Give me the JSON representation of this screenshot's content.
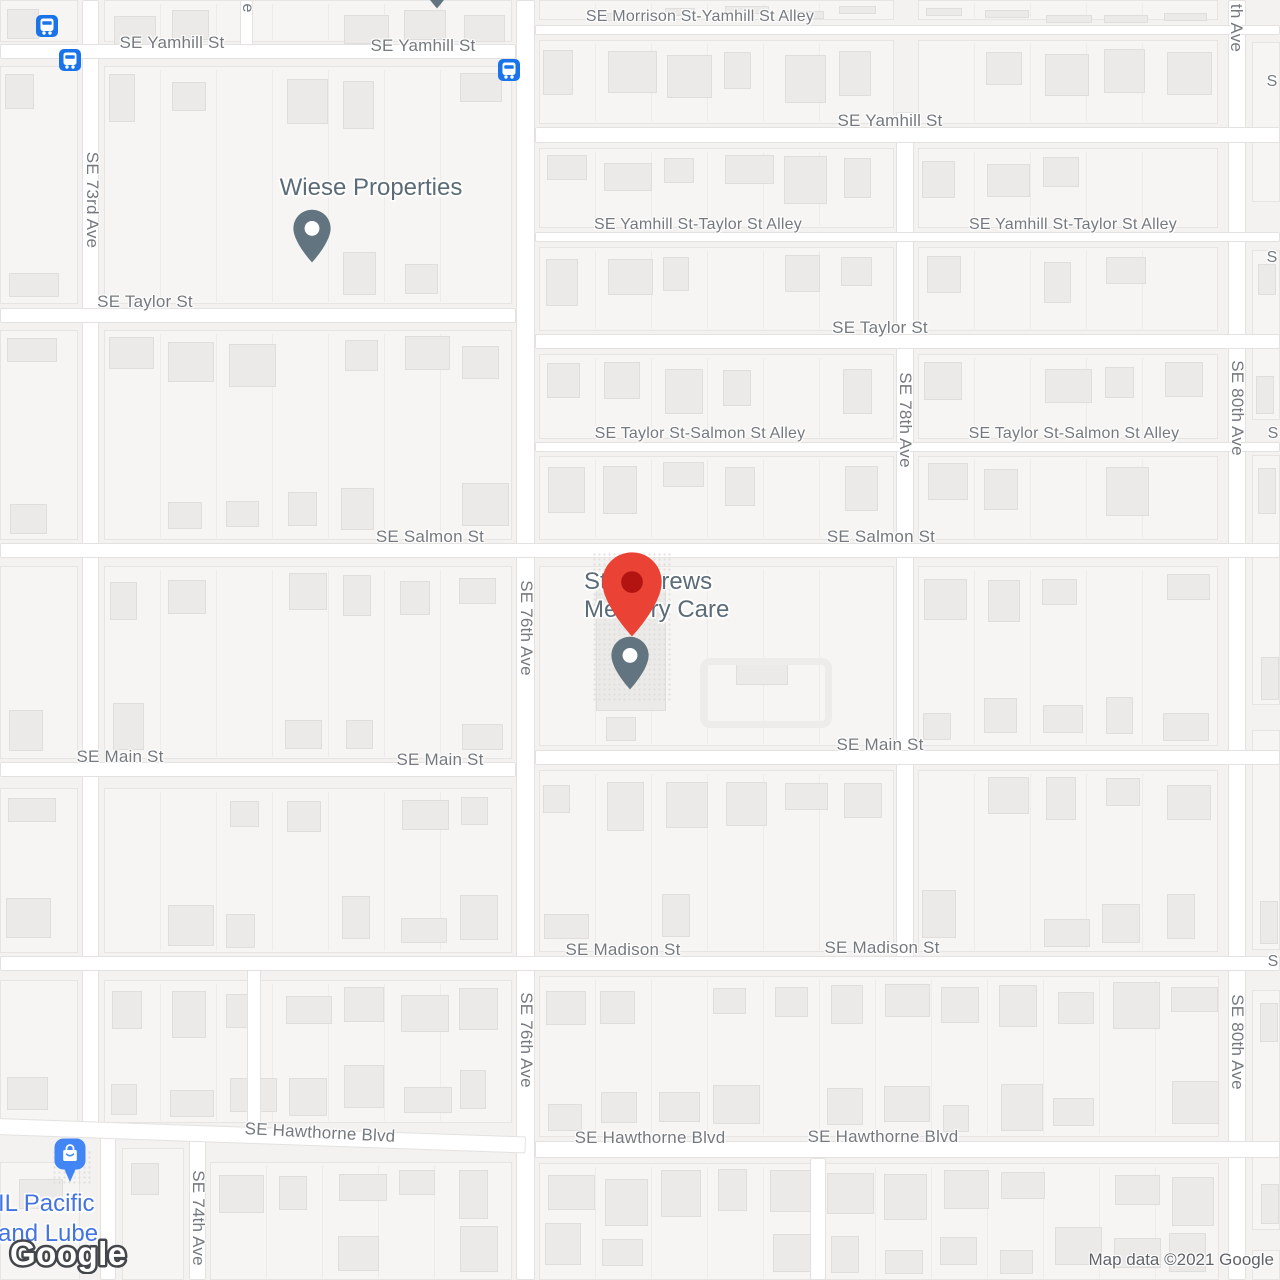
{
  "map": {
    "provider": "Google Maps",
    "attribution": {
      "logo": "Google",
      "copyright": "Map data ©2021 Google"
    },
    "pois": [
      {
        "name": "Wiese Properties",
        "marker": "slate-pin"
      },
      {
        "name": "St. Andrews Memory Care",
        "line1": "St. Andrews",
        "line2": "Memory Care",
        "marker": "red-pin-over-slate-pin"
      },
      {
        "name": "IL Pacific and Lube",
        "line1": "IL Pacific",
        "line2": "and Lube",
        "marker": "blue-shopping-pin"
      }
    ],
    "colors": {
      "road_fill": "#ffffff",
      "road_edge": "#e3e2e0",
      "block_fill": "#f6f5f3",
      "building_fill": "#ebeae8",
      "street_label": "#75797e",
      "poi_label_slate": "#5b6b77",
      "poi_label_blue": "#4374e0",
      "marker_red": "#EA4335",
      "marker_red_dot": "#B31412",
      "marker_slate": "#61747f",
      "marker_blue": "#4285F4",
      "bus_icon_blue": "#1A73E8"
    },
    "street_labels": [
      {
        "t": "SE Yamhill St",
        "x": 172,
        "y": 43,
        "s": 17
      },
      {
        "t": "SE Yamhill St",
        "x": 423,
        "y": 46,
        "s": 17
      },
      {
        "t": "SE Morrison St-Yamhill St Alley",
        "x": 700,
        "y": 17,
        "s": 16
      },
      {
        "t": "SE Yamhill St",
        "x": 890,
        "y": 121,
        "s": 17
      },
      {
        "t": "SE Yamhill St-Taylor St Alley",
        "x": 698,
        "y": 225,
        "s": 16
      },
      {
        "t": "SE Yamhill St-Taylor St Alley",
        "x": 1073,
        "y": 225,
        "s": 16
      },
      {
        "t": "SE Taylor St",
        "x": 145,
        "y": 302,
        "s": 17
      },
      {
        "t": "SE Taylor St",
        "x": 880,
        "y": 328,
        "s": 17
      },
      {
        "t": "SE Taylor St-Salmon St Alley",
        "x": 700,
        "y": 434,
        "s": 16
      },
      {
        "t": "SE Taylor St-Salmon St Alley",
        "x": 1074,
        "y": 434,
        "s": 16
      },
      {
        "t": "SE Salmon St",
        "x": 430,
        "y": 537,
        "s": 17
      },
      {
        "t": "SE Salmon St",
        "x": 881,
        "y": 537,
        "s": 17
      },
      {
        "t": "SE Main St",
        "x": 120,
        "y": 757,
        "s": 17
      },
      {
        "t": "SE Main St",
        "x": 440,
        "y": 760,
        "s": 17
      },
      {
        "t": "SE Main St",
        "x": 880,
        "y": 745,
        "s": 17
      },
      {
        "t": "SE Madison St",
        "x": 623,
        "y": 950,
        "s": 17
      },
      {
        "t": "SE Madison St",
        "x": 882,
        "y": 948,
        "s": 17
      },
      {
        "t": "SE Hawthorne Blvd",
        "x": 320,
        "y": 1133,
        "s": 17,
        "r": 3
      },
      {
        "t": "SE Hawthorne Blvd",
        "x": 650,
        "y": 1138,
        "s": 17
      },
      {
        "t": "SE Hawthorne Blvd",
        "x": 883,
        "y": 1137,
        "s": 17
      },
      {
        "t": "SE 73rd Ave",
        "x": 92,
        "y": 200,
        "s": 17,
        "r": 90
      },
      {
        "t": "SE 74th Ave",
        "x": 198,
        "y": 1218,
        "s": 17,
        "r": 90
      },
      {
        "t": "SE 76th Ave",
        "x": 526,
        "y": 628,
        "s": 17,
        "r": 90
      },
      {
        "t": "SE 76th Ave",
        "x": 526,
        "y": 1040,
        "s": 17,
        "r": 90
      },
      {
        "t": "SE 78th Ave",
        "x": 905,
        "y": 420,
        "s": 17,
        "r": 90
      },
      {
        "t": "SE 80th Ave",
        "x": 1237,
        "y": 408,
        "s": 17,
        "r": 90
      },
      {
        "t": "SE 80th Ave",
        "x": 1237,
        "y": 1042,
        "s": 17,
        "r": 90
      },
      {
        "t": "th Ave",
        "x": 1236,
        "y": 28,
        "s": 17,
        "r": 90
      },
      {
        "t": "e",
        "x": 247,
        "y": 8,
        "s": 16,
        "r": 90
      },
      {
        "t": "S",
        "x": 1272,
        "y": 82,
        "s": 16
      },
      {
        "t": "S",
        "x": 1272,
        "y": 258,
        "s": 16
      },
      {
        "t": "S",
        "x": 1273,
        "y": 434,
        "s": 16
      },
      {
        "t": "S",
        "x": 1273,
        "y": 962,
        "s": 16
      }
    ],
    "roads": [
      {
        "x": 82,
        "y": 0,
        "w": 17,
        "h": 1134
      },
      {
        "x": 100,
        "y": 1130,
        "w": 16,
        "h": 150
      },
      {
        "x": 189,
        "y": 1128,
        "w": 17,
        "h": 152
      },
      {
        "x": 247,
        "y": 956,
        "w": 14,
        "h": 180
      },
      {
        "x": 240,
        "y": 0,
        "w": 13,
        "h": 58
      },
      {
        "x": 516,
        "y": 0,
        "w": 19,
        "h": 1280
      },
      {
        "x": 896,
        "y": 112,
        "w": 18,
        "h": 852
      },
      {
        "x": 1228,
        "y": 0,
        "w": 18,
        "h": 1280
      },
      {
        "x": 810,
        "y": 1158,
        "w": 16,
        "h": 122
      },
      {
        "x": 0,
        "y": 44,
        "w": 516,
        "h": 15
      },
      {
        "x": 535,
        "y": 25,
        "w": 745,
        "h": 10
      },
      {
        "x": 535,
        "y": 127,
        "w": 745,
        "h": 16
      },
      {
        "x": 535,
        "y": 232,
        "w": 745,
        "h": 10
      },
      {
        "x": 0,
        "y": 308,
        "w": 516,
        "h": 15
      },
      {
        "x": 535,
        "y": 334,
        "w": 745,
        "h": 15
      },
      {
        "x": 535,
        "y": 442,
        "w": 745,
        "h": 10
      },
      {
        "x": 0,
        "y": 543,
        "w": 1280,
        "h": 15
      },
      {
        "x": 0,
        "y": 762,
        "w": 516,
        "h": 15
      },
      {
        "x": 535,
        "y": 750,
        "w": 745,
        "h": 15
      },
      {
        "x": 0,
        "y": 956,
        "w": 1280,
        "h": 15
      },
      {
        "x": -4,
        "y": 1118,
        "w": 530,
        "h": 17,
        "rot": 2
      },
      {
        "x": 535,
        "y": 1141,
        "w": 745,
        "h": 17
      }
    ],
    "blocks": [
      {
        "x": 0,
        "y": 0,
        "w": 78,
        "h": 42
      },
      {
        "x": 104,
        "y": 0,
        "w": 408,
        "h": 42
      },
      {
        "x": 0,
        "y": 66,
        "w": 78,
        "h": 238
      },
      {
        "x": 104,
        "y": 66,
        "w": 408,
        "h": 238
      },
      {
        "x": 0,
        "y": 330,
        "w": 78,
        "h": 210
      },
      {
        "x": 104,
        "y": 330,
        "w": 408,
        "h": 210
      },
      {
        "x": 0,
        "y": 566,
        "w": 78,
        "h": 193
      },
      {
        "x": 104,
        "y": 566,
        "w": 408,
        "h": 193
      },
      {
        "x": 0,
        "y": 788,
        "w": 78,
        "h": 165
      },
      {
        "x": 104,
        "y": 788,
        "w": 408,
        "h": 165
      },
      {
        "x": 0,
        "y": 980,
        "w": 78,
        "h": 143
      },
      {
        "x": 104,
        "y": 980,
        "w": 408,
        "h": 143
      },
      {
        "x": 0,
        "y": 1162,
        "w": 80,
        "h": 118,
        "custom": [
          [
            18,
            16,
            44,
            30
          ]
        ]
      },
      {
        "x": 122,
        "y": 1148,
        "w": 62,
        "h": 132
      },
      {
        "x": 210,
        "y": 1162,
        "w": 302,
        "h": 118
      },
      {
        "x": 539,
        "y": 0,
        "w": 355,
        "h": 20
      },
      {
        "x": 918,
        "y": 0,
        "w": 300,
        "h": 20
      },
      {
        "x": 539,
        "y": 40,
        "w": 355,
        "h": 84
      },
      {
        "x": 918,
        "y": 40,
        "w": 300,
        "h": 84
      },
      {
        "x": 539,
        "y": 148,
        "w": 355,
        "h": 80
      },
      {
        "x": 918,
        "y": 148,
        "w": 300,
        "h": 80
      },
      {
        "x": 539,
        "y": 247,
        "w": 355,
        "h": 84
      },
      {
        "x": 918,
        "y": 247,
        "w": 300,
        "h": 84
      },
      {
        "x": 539,
        "y": 354,
        "w": 355,
        "h": 85
      },
      {
        "x": 918,
        "y": 354,
        "w": 300,
        "h": 85
      },
      {
        "x": 539,
        "y": 456,
        "w": 355,
        "h": 84
      },
      {
        "x": 918,
        "y": 456,
        "w": 300,
        "h": 84
      },
      {
        "x": 539,
        "y": 566,
        "w": 355,
        "h": 180,
        "custom": [
          [
            56,
            16,
            70,
            128
          ],
          [
            66,
            150,
            30,
            24
          ],
          [
            196,
            92,
            52,
            26
          ]
        ]
      },
      {
        "x": 918,
        "y": 566,
        "w": 300,
        "h": 180
      },
      {
        "x": 539,
        "y": 770,
        "w": 355,
        "h": 182
      },
      {
        "x": 918,
        "y": 770,
        "w": 300,
        "h": 182
      },
      {
        "x": 539,
        "y": 976,
        "w": 680,
        "h": 161
      },
      {
        "x": 539,
        "y": 1163,
        "w": 680,
        "h": 117
      },
      {
        "x": 1252,
        "y": 42,
        "w": 28,
        "h": 160
      },
      {
        "x": 1252,
        "y": 250,
        "w": 28,
        "h": 170
      },
      {
        "x": 1252,
        "y": 455,
        "w": 28,
        "h": 250
      },
      {
        "x": 1252,
        "y": 730,
        "w": 28,
        "h": 220
      },
      {
        "x": 1252,
        "y": 990,
        "w": 28,
        "h": 240
      },
      {
        "x": 1252,
        "y": 1250,
        "w": 28,
        "h": 30
      }
    ],
    "markers": {
      "bus_stops": [
        {
          "x": 47,
          "y": 26
        },
        {
          "x": 70,
          "y": 60
        },
        {
          "x": 509,
          "y": 70
        }
      ],
      "red_pin_tip": {
        "x": 632,
        "y": 640
      },
      "slate_pin_st_andrews_tip": {
        "x": 630,
        "y": 691
      },
      "slate_pin_wiese_tip": {
        "x": 312,
        "y": 264
      },
      "blue_shopping_pin_tip": {
        "x": 70,
        "y": 1183
      },
      "cut_pin_top_x": 437
    }
  }
}
